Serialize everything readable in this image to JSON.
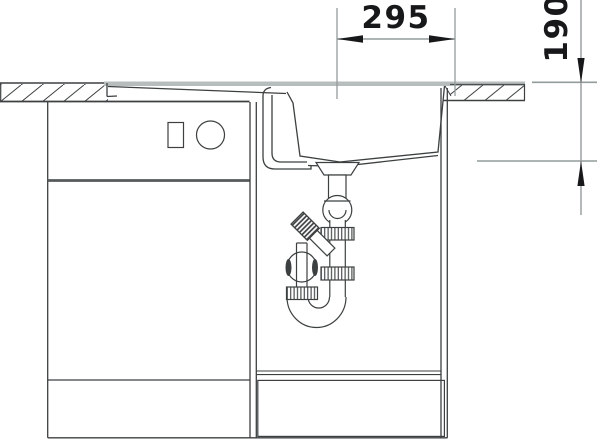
{
  "diagram": {
    "dimensions": {
      "width_mm": "295",
      "depth_mm": "190"
    },
    "colors": {
      "line": "#3c4040",
      "dimension_line": "#949b9b",
      "dimension_text": "#17181a",
      "surface_gray": "#b7bdbd",
      "background": "#ffffff"
    }
  }
}
